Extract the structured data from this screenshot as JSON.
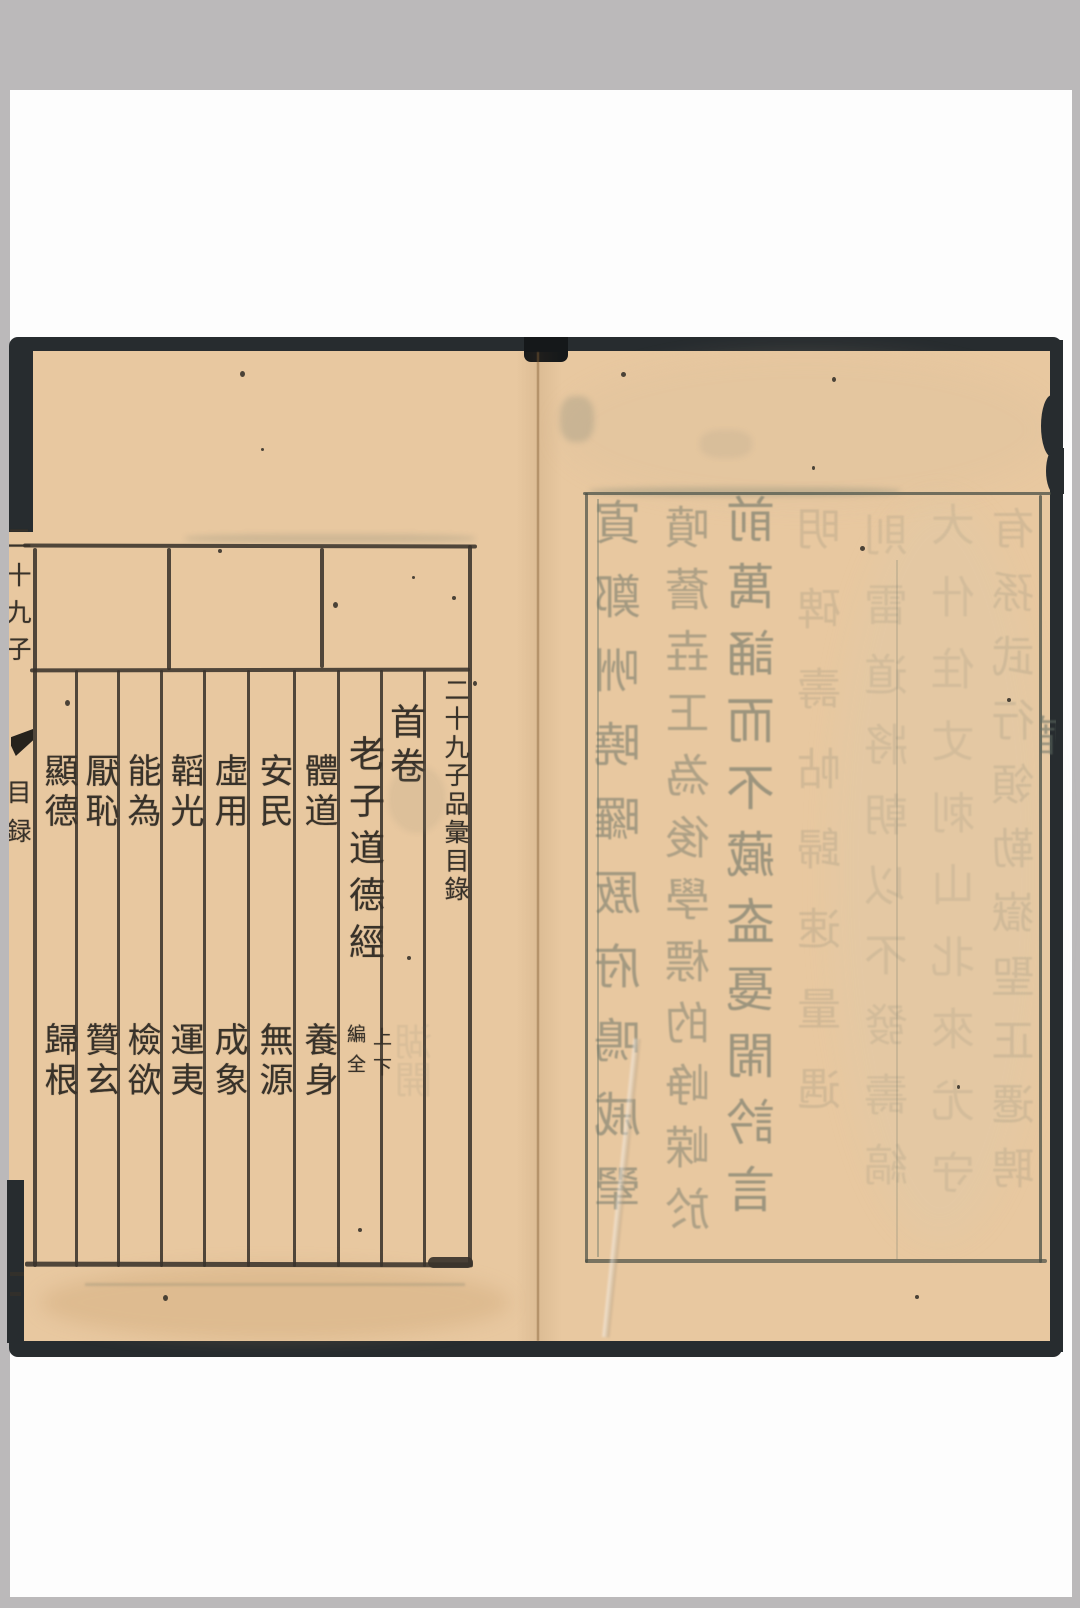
{
  "colors": {
    "scan_background": "#bbb9ba",
    "scan_white": "#fdfdfd",
    "book_edge": "#272c2f",
    "paper": "#e8c8a0",
    "ink": "#38322a",
    "ghost_ink": "#5f6b62",
    "rule_line": "#3a332b",
    "crease": "#825c34"
  },
  "left_page": {
    "spine": {
      "title_partial": "二十九子",
      "fishtail_icon": "fishtail-ornament",
      "section_partial": "目録"
    },
    "toc": {
      "title": "二十九子品彙目錄",
      "volume_heading": "首卷",
      "work_title": "老子道德經",
      "work_annotation": {
        "right_column": "上下",
        "left_column": "編全"
      },
      "chapters": [
        {
          "upper": "體道",
          "lower": "養身"
        },
        {
          "upper": "安民",
          "lower": "無源"
        },
        {
          "upper": "虛用",
          "lower": "成象"
        },
        {
          "upper": "韜光",
          "lower": "運夷"
        },
        {
          "upper": "能為",
          "lower": "檢欲"
        },
        {
          "upper": "厭恥",
          "lower": "贊玄"
        },
        {
          "upper": "顯德",
          "lower": "歸根"
        }
      ]
    }
  },
  "right_page": {
    "bleedthrough_columns": [
      {
        "chars": "寊鄭㖄曉曪厫府鳴戚翚",
        "opacity": 0.5
      },
      {
        "chars": "噴薝壵㠪為後學標的峥嵘於",
        "opacity": 0.42
      },
      {
        "chars": "前萬誦而不藏盇戞閙訡言",
        "opacity": 0.55
      },
      {
        "chars": "明碑壽帖歸速量遇",
        "opacity": 0.16
      },
      {
        "chars": "則雷道將朝以不發壽縞",
        "opacity": 0.13
      },
      {
        "chars": "大什住丈刺山北來尤守",
        "opacity": 0.12
      },
      {
        "chars": "有孫武行領勒嶽聖正遷聘",
        "opacity": 0.15
      }
    ],
    "left_page_ghost_chars": "湖開",
    "edge_partial_char": "庿"
  }
}
